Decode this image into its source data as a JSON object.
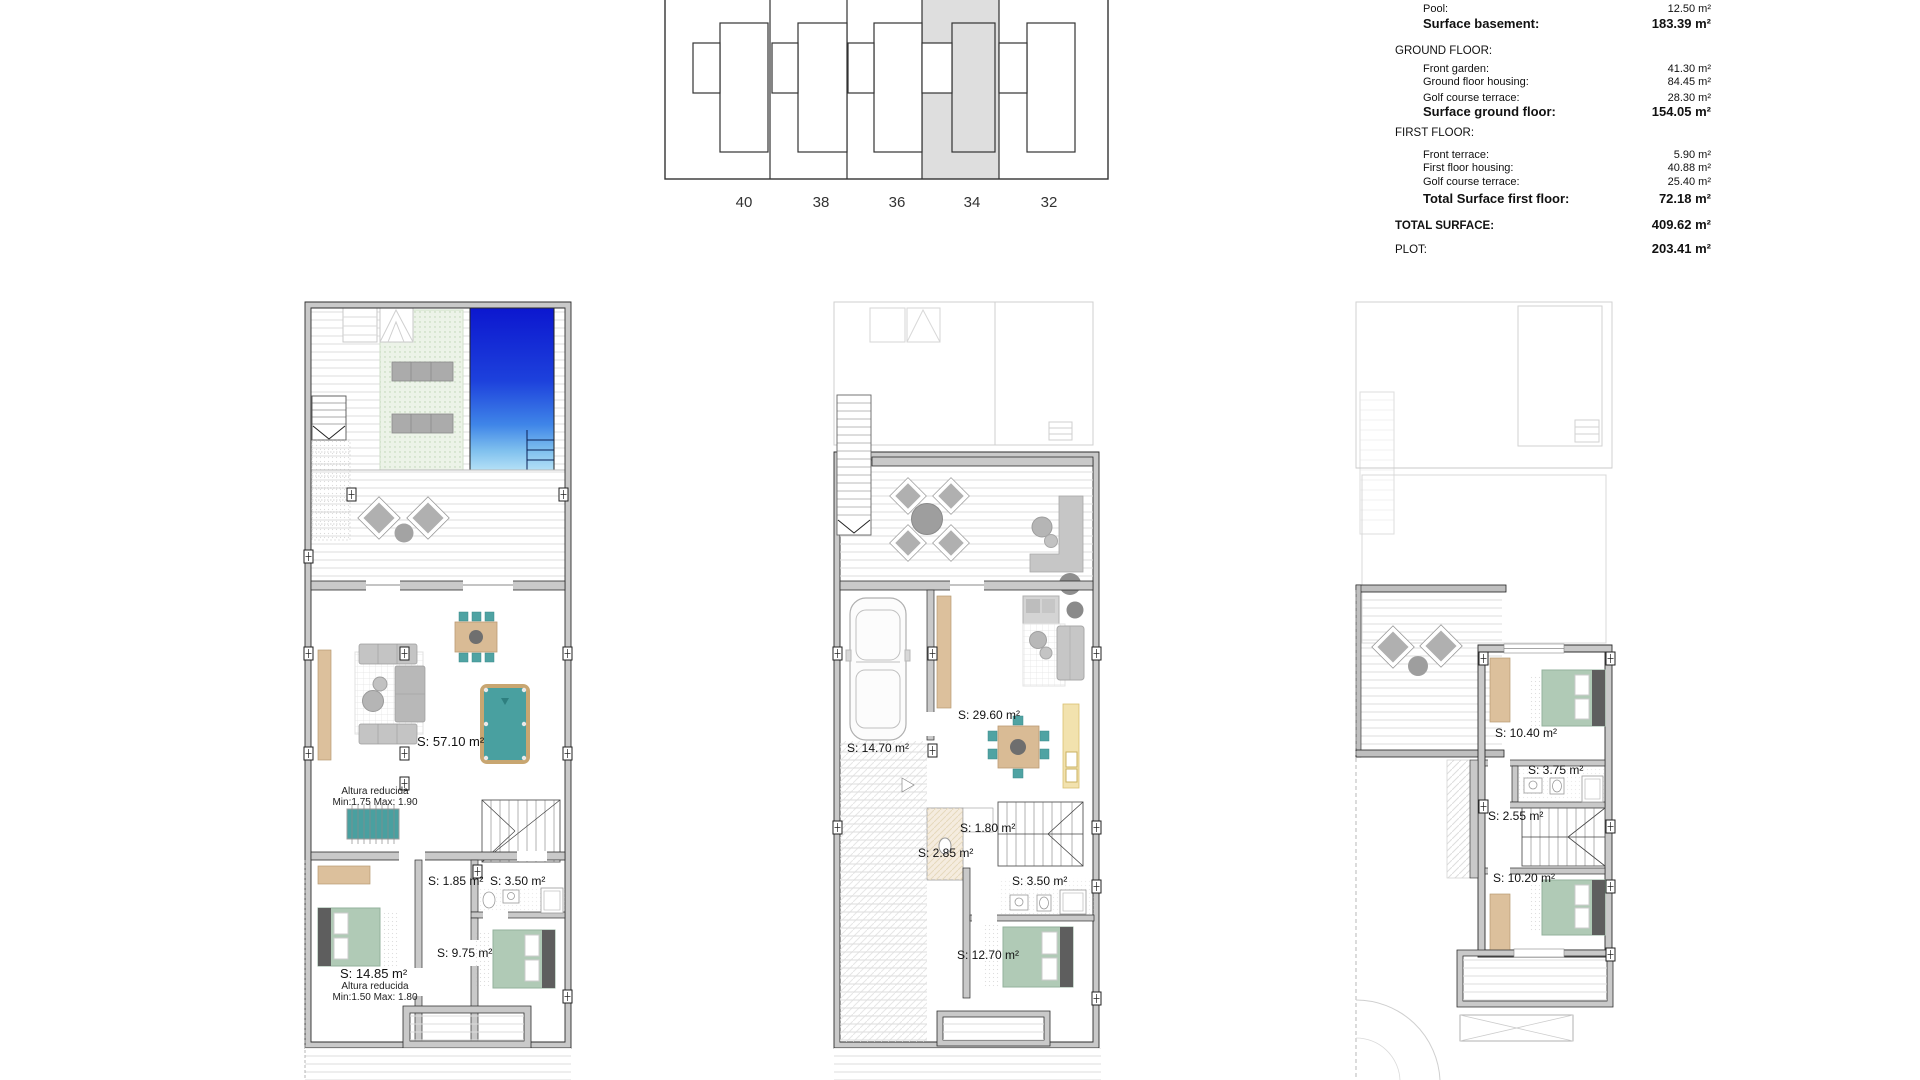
{
  "document": {
    "type": "floor-plan-sheet",
    "background": "#ffffff"
  },
  "colors": {
    "wall_fill": "#c9c9c9",
    "wall_stroke": "#2e2e2e",
    "pool_top": "#0c17cf",
    "pool_bottom": "#b4e0f6",
    "lawn": "#ecf3e8",
    "bed_green": "#b0cab6",
    "wood_tan": "#dcc09c",
    "teal_furniture": "#4fa3a3",
    "kitchen_cream": "#f2e2ae",
    "highlight_unit_gray": "#dedede",
    "deck_line": "#dcdcdc"
  },
  "site_plan": {
    "units": [
      "40",
      "38",
      "36",
      "34",
      "32"
    ],
    "highlighted_unit": "34"
  },
  "surface_table": {
    "rows": [
      {
        "label": "Golf course terrace:",
        "value": "34.10 m²"
      },
      {
        "label": "Pool:",
        "value": "12.50 m²"
      },
      {
        "label": "Surface basement:",
        "value": "183.39 m²"
      },
      {
        "label": "GROUND FLOOR:",
        "value": ""
      },
      {
        "label": "Front garden:",
        "value": "41.30 m²"
      },
      {
        "label": "Ground floor housing:",
        "value": "84.45 m²"
      },
      {
        "label": "Golf course terrace:",
        "value": "28.30 m²"
      },
      {
        "label": "Surface ground floor:",
        "value": "154.05 m²"
      },
      {
        "label": "FIRST FLOOR:",
        "value": ""
      },
      {
        "label": "Front terrace:",
        "value": "5.90 m²"
      },
      {
        "label": "First floor housing:",
        "value": "40.88 m²"
      },
      {
        "label": "Golf course terrace:",
        "value": "25.40 m²"
      },
      {
        "label": "Total Surface first floor:",
        "value": "72.18 m²"
      },
      {
        "label": "TOTAL SURFACE:",
        "value": "409.62 m²"
      },
      {
        "label": "PLOT:",
        "value": "203.41 m²"
      }
    ]
  },
  "plans": {
    "basement": {
      "labels": {
        "main_room": "S: 57.10 m²",
        "note1_line1": "Altura reducida",
        "note1_line2": "Min:1.75 Max: 1.90",
        "store": "S: 1.85 m²",
        "bath": "S: 3.50 m²",
        "corridor": "S: 9.75 m²",
        "bedroom": "S: 14.85 m²",
        "note2_line1": "Altura reducida",
        "note2_line2": "Min:1.50 Max: 1.80"
      }
    },
    "ground": {
      "labels": {
        "garage": "S: 14.70 m²",
        "living": "S: 29.60 m²",
        "wc": "S: 1.80 m²",
        "hall": "S: 2.85 m²",
        "bath": "S: 3.50 m²",
        "bedroom": "S: 12.70 m²"
      }
    },
    "first": {
      "labels": {
        "bedroom1": "S: 10.40 m²",
        "bath": "S: 3.75 m²",
        "hall": "S: 2.55 m²",
        "bedroom2": "S: 10.20 m²"
      }
    }
  }
}
